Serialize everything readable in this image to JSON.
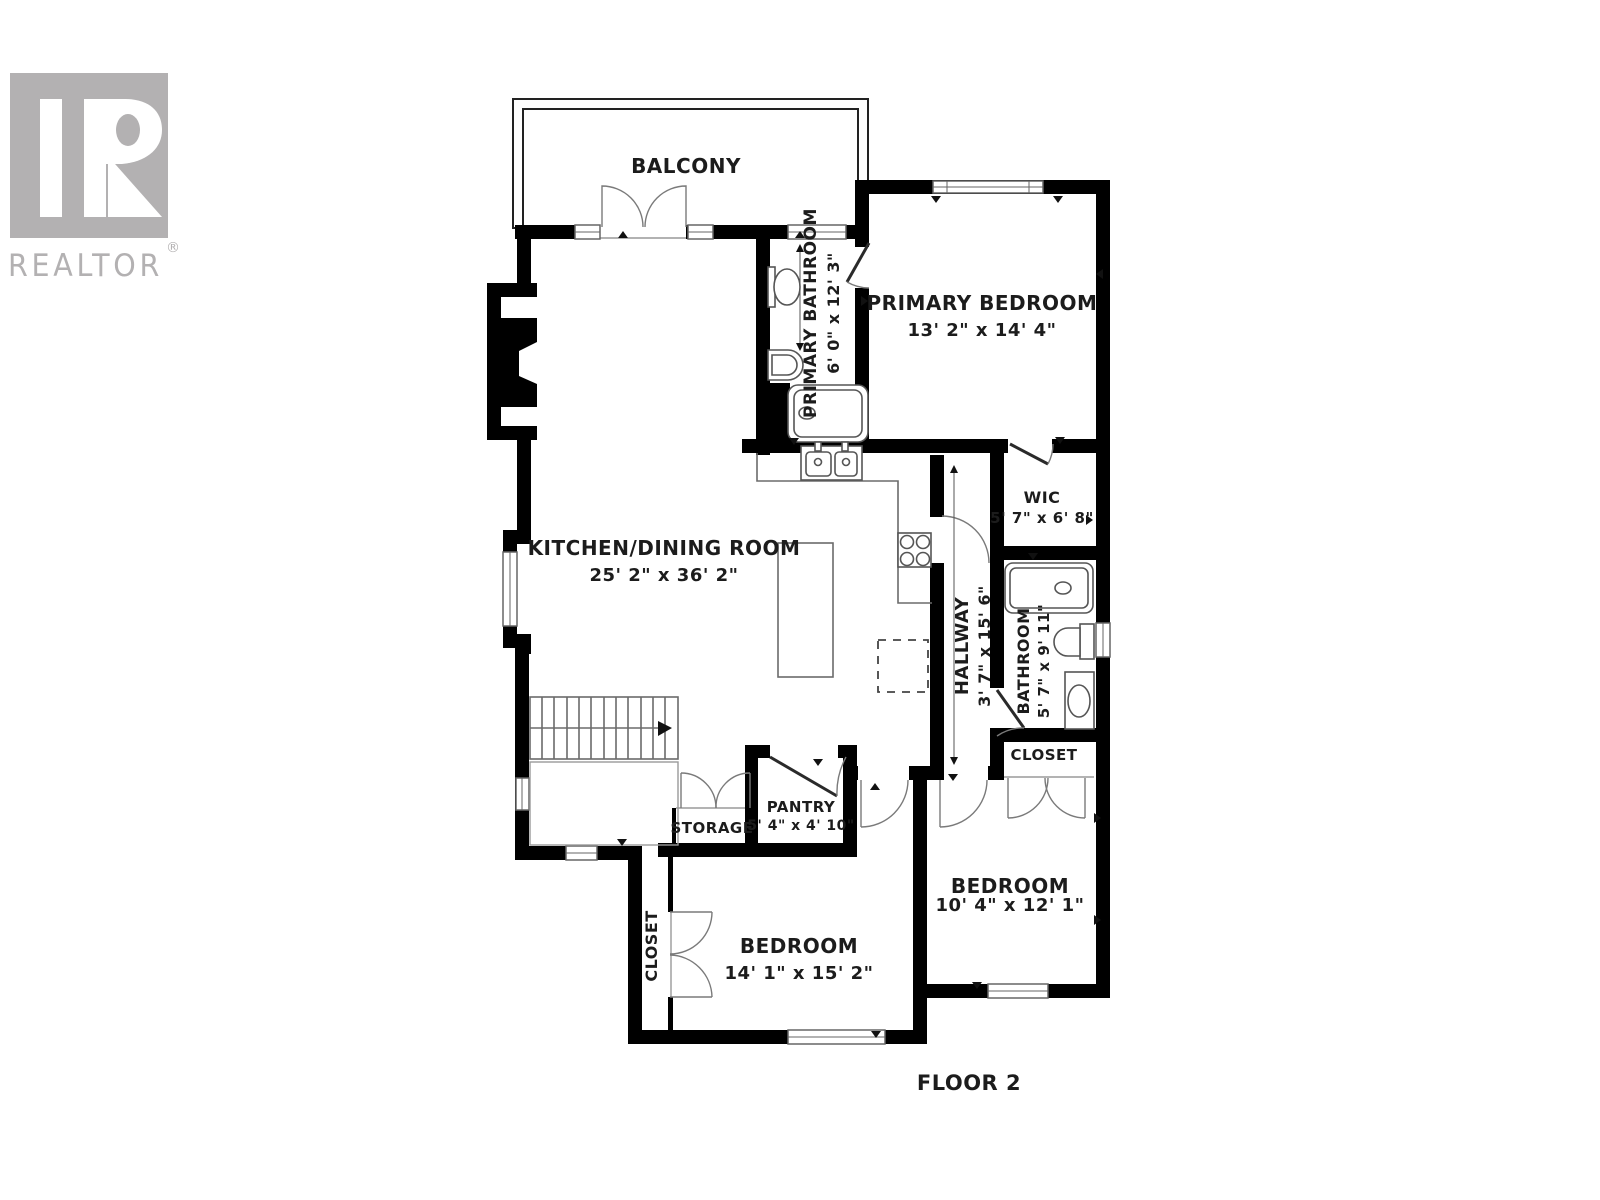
{
  "logo": {
    "text": "REALTOR",
    "mark": "®"
  },
  "floor_label": "FLOOR 2",
  "colors": {
    "wall": "#000000",
    "logo_gray": "#b3b1b2",
    "thin_line": "#6b6b6b",
    "text": "#1c1c1c",
    "background": "#ffffff"
  },
  "rooms": [
    {
      "id": "balcony",
      "name": "BALCONY",
      "dimensions": ""
    },
    {
      "id": "primary_bathroom",
      "name": "PRIMARY BATHROOM",
      "dimensions": "6' 0\" x 12' 3\""
    },
    {
      "id": "primary_bedroom",
      "name": "PRIMARY BEDROOM",
      "dimensions": "13' 2\" x 14' 4\""
    },
    {
      "id": "kitchen_dining",
      "name": "KITCHEN/DINING ROOM",
      "dimensions": "25' 2\" x 36' 2\""
    },
    {
      "id": "wic",
      "name": "WIC",
      "dimensions": "5' 7\" x 6' 8\""
    },
    {
      "id": "hallway",
      "name": "HALLWAY",
      "dimensions": "3' 7\" x 15' 6\""
    },
    {
      "id": "bathroom",
      "name": "BATHROOM",
      "dimensions": "5' 7\" x 9' 11\""
    },
    {
      "id": "closet_hall",
      "name": "CLOSET",
      "dimensions": ""
    },
    {
      "id": "pantry",
      "name": "PANTRY",
      "dimensions": "5' 4\" x 4' 10\""
    },
    {
      "id": "storage",
      "name": "STORAGE",
      "dimensions": ""
    },
    {
      "id": "bedroom_left",
      "name": "BEDROOM",
      "dimensions": "14' 1\" x 15' 2\""
    },
    {
      "id": "closet_bedroom",
      "name": "CLOSET",
      "dimensions": ""
    },
    {
      "id": "bedroom_right",
      "name": "BEDROOM",
      "dimensions": "10' 4\" x 12' 1\""
    }
  ]
}
